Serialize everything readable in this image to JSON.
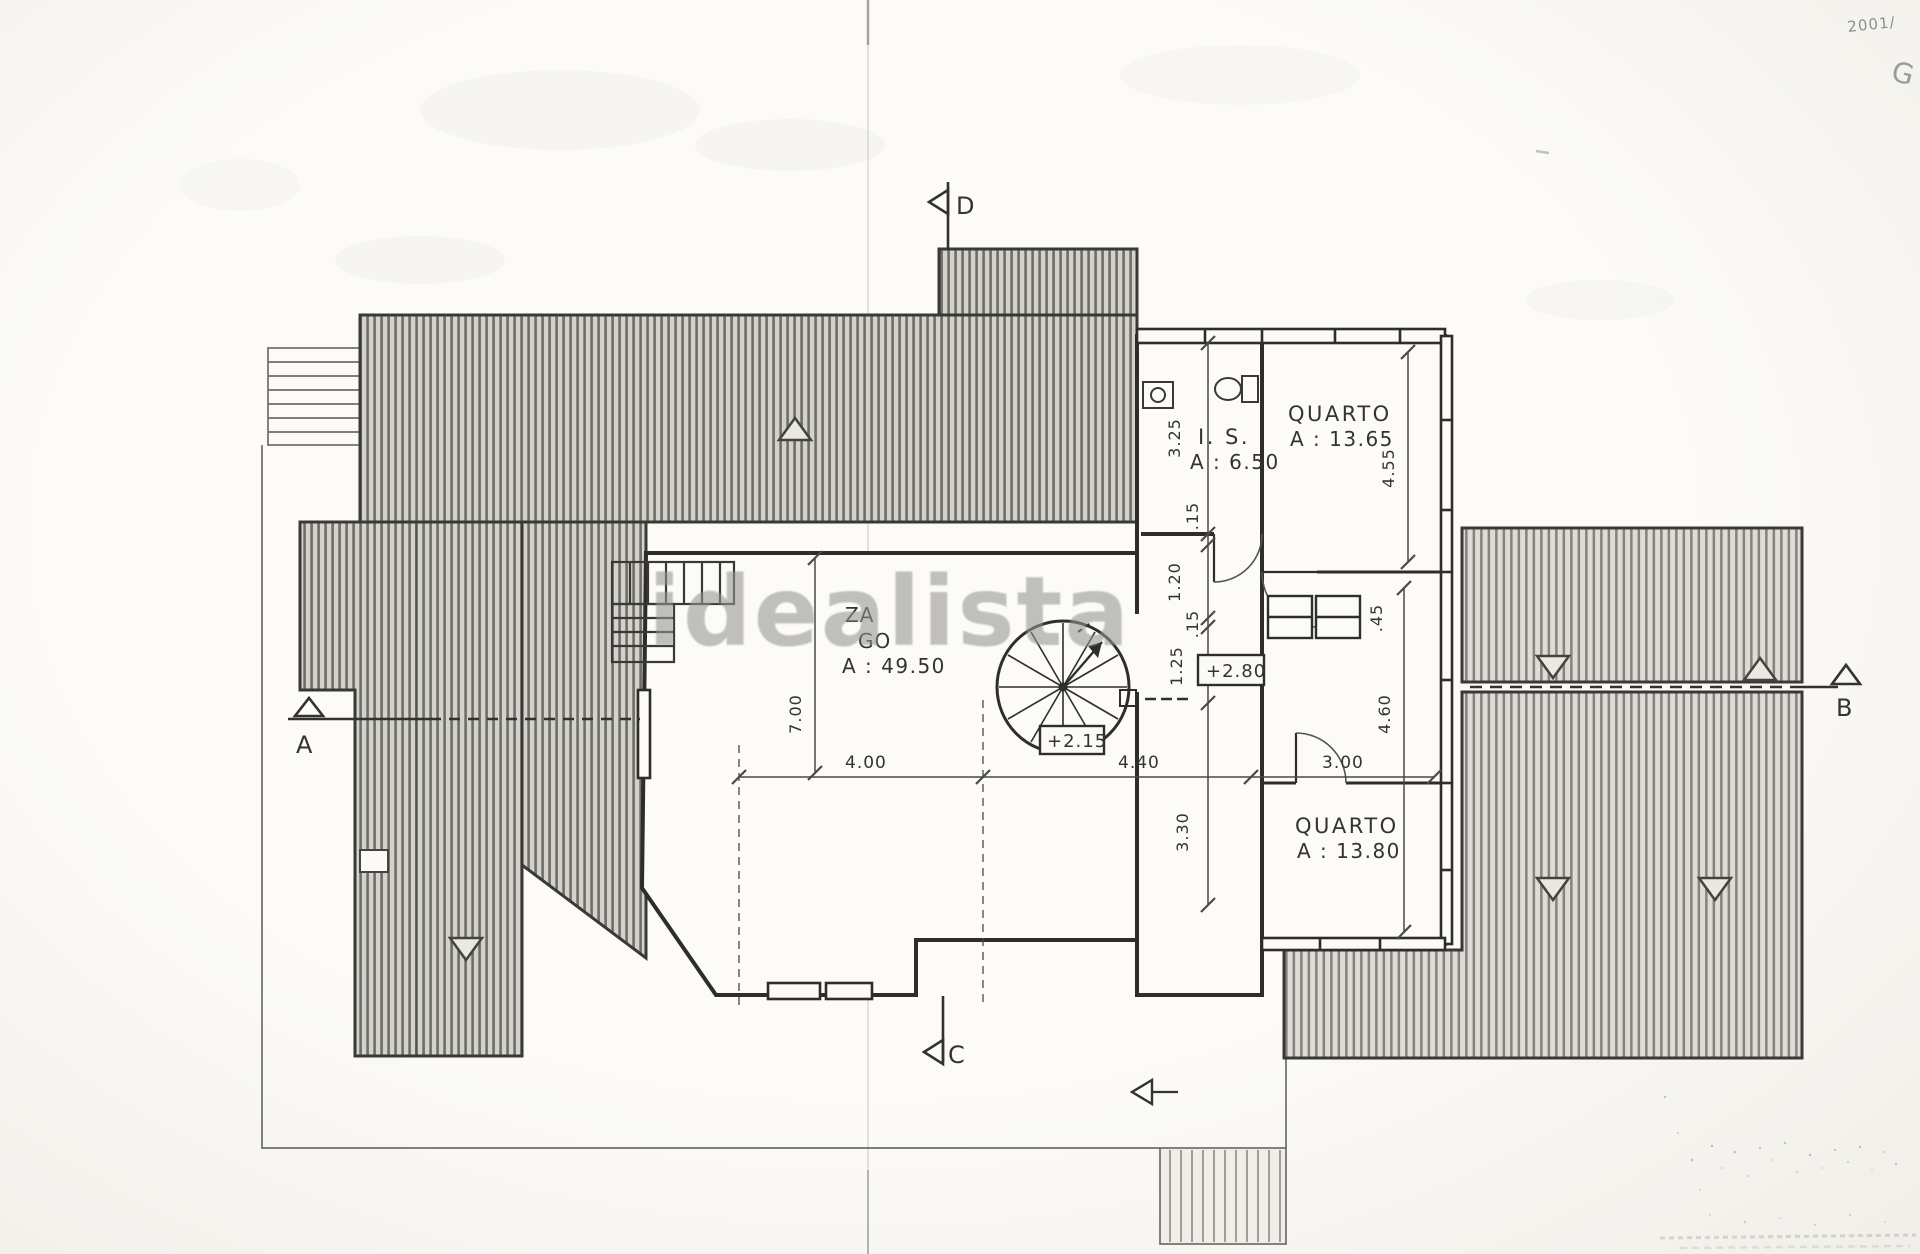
{
  "watermark": "idealista",
  "handwriting": {
    "top": "2001/",
    "initial": "G"
  },
  "rooms": {
    "living": {
      "frag1": "ZA",
      "frag2": "GO",
      "area": "A : 49.50"
    },
    "bathroom": {
      "name": "I. S.",
      "area": "A : 6.50"
    },
    "bedroom_top": {
      "name": "QUARTO",
      "area": "A : 13.65"
    },
    "bedroom_bottom": {
      "name": "QUARTO",
      "area": "A : 13.80"
    }
  },
  "levels": {
    "upper": "+2.80",
    "landing": "+2.15"
  },
  "dimensions": {
    "horizontal": [
      "4.00",
      "4.40",
      "3.00"
    ],
    "corridor_chain": [
      "3.25",
      ".15",
      "1.20",
      ".15",
      "1.25",
      "3.30"
    ],
    "room_heights": [
      "4.55",
      "4.60"
    ],
    "living_height": "7.00",
    "closet_depth": ".45"
  },
  "section_markers": [
    "A",
    "B",
    "C",
    "D"
  ]
}
